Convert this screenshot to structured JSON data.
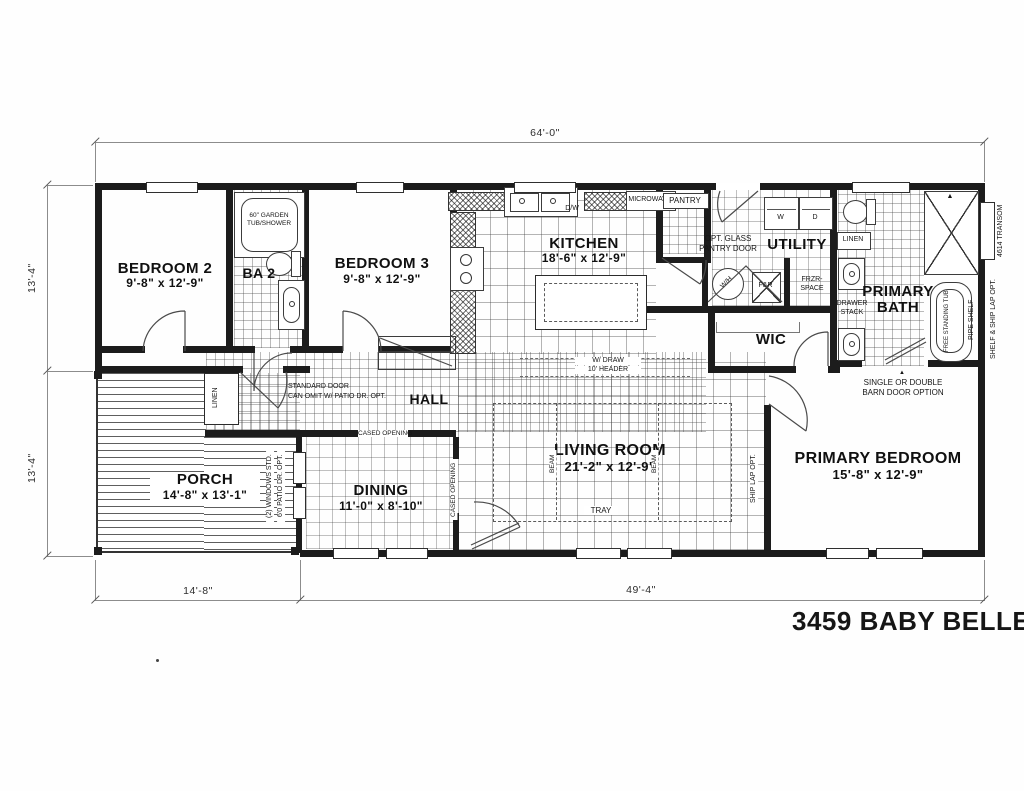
{
  "title": "3459 BABY BELLE",
  "colors": {
    "ink": "#1a1a1a",
    "paper": "#ffffff"
  },
  "dimensions": {
    "overall_width": "64'-0\"",
    "left_upper": "13'-4\"",
    "left_lower": "13'-4\"",
    "bottom_left": "14'-8\"",
    "bottom_right": "49'-4\""
  },
  "rooms": {
    "bedroom2": {
      "name": "BEDROOM 2",
      "size": "9'-8\" x 12'-9\""
    },
    "ba2": {
      "name": "BA 2"
    },
    "bedroom3": {
      "name": "BEDROOM 3",
      "size": "9'-8\" x 12'-9\""
    },
    "kitchen": {
      "name": "KITCHEN",
      "size": "18'-6\" x 12'-9\""
    },
    "pantry": {
      "name": "PANTRY"
    },
    "utility": {
      "name": "UTILITY"
    },
    "primary_bath": {
      "line1": "PRIMARY",
      "line2": "BATH"
    },
    "wic": {
      "name": "WIC"
    },
    "hall": {
      "name": "HALL"
    },
    "dining": {
      "name": "DINING",
      "size": "11'-0\" x 8'-10\""
    },
    "living": {
      "name": "LIVING ROOM",
      "size": "21'-2\" x 12'-9\""
    },
    "primary_bedroom": {
      "name": "PRIMARY BEDROOM",
      "size": "15'-8\" x 12'-9\""
    },
    "porch": {
      "name": "PORCH",
      "size": "14'-8\" x 13'-1\""
    }
  },
  "fixtures": {
    "garden_tub_line1": "60\" GARDEN",
    "garden_tub_line2": "TUB/SHOWER",
    "microwave": "MICROWAVE",
    "dishwasher": "D/W",
    "washer": "W",
    "dryer": "D",
    "water_heater": "W/H",
    "furnace": "F&R",
    "frzr_line1": "FRZR-",
    "frzr_line2": "SPACE",
    "linen_bath": "LINEN",
    "linen_hall": "LINEN",
    "drawer_stack_line1": "DRAWER",
    "drawer_stack_line2": "STACK",
    "free_standing_tub": "FREE STANDING TUB",
    "pipe_shelf": "PIPE SHELF"
  },
  "notes": {
    "opt_glass_line1": "OPT. GLASS",
    "opt_glass_line2": "PANTRY DOOR",
    "std_door_line1": "STANDARD DOOR",
    "std_door_line2": "CAN OMIT W/ PATIO DR. OPT.",
    "cased_opening_top": "CASED OPENING",
    "cased_opening_side": "CASED OPENING",
    "header_line1": "W/ DRAW",
    "header_line2": "10' HEADER",
    "beam_left": "BEAM",
    "beam_right": "BEAM",
    "tray": "TRAY",
    "ship_lap": "SHIP LAP OPT.",
    "shelf_ship_lap": "SHELF & SHIP LAP OPT.",
    "transom": "4614 TRANSOM",
    "barn_line1": "SINGLE OR DOUBLE",
    "barn_line2": "BARN DOOR OPTION",
    "barn_arrow": "▲",
    "windows_std": "(2) WINDOWS STD.",
    "patio_dr": "6'0 PATIO DR. OPT."
  }
}
